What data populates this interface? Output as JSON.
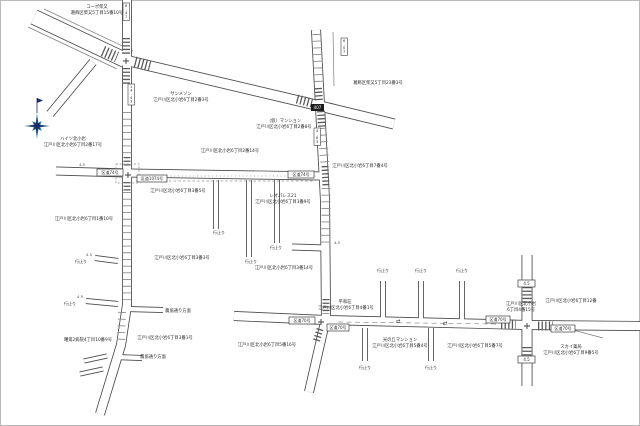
{
  "map": {
    "theme": {
      "bg": "#ffffff",
      "frame": "#b9b9b9",
      "casing": "#4a4a4a",
      "zebra": "#5a5a5a",
      "tick": "#8c8c8c",
      "dash": "#909090",
      "text": "#2b2b2b",
      "sign_border": "#3c3c3c",
      "black_sign_bg": "#1c1c1c",
      "black_sign_text": "#ffffff",
      "compass_navy": "#1b2a6d",
      "compass_teal": "#2f7d93"
    },
    "region_labels": [
      {
        "x": 97,
        "y": 8,
        "t": "コーポ柴又"
      },
      {
        "x": 97,
        "y": 14,
        "t": "葛飾区柴又5丁目15番10号"
      },
      {
        "x": 378,
        "y": 84,
        "t": "葛飾区柴又5丁目23番3号"
      },
      {
        "x": 181,
        "y": 95,
        "t": "サンメゾン"
      },
      {
        "x": 181,
        "y": 101,
        "t": "江戸川区北小岩6丁目2番3号"
      },
      {
        "x": 284,
        "y": 122,
        "t": "（仮）マンション"
      },
      {
        "x": 284,
        "y": 128,
        "t": "江戸川区北小岩6丁目2番8号"
      },
      {
        "x": 73,
        "y": 140,
        "t": "ハイツ北小岩"
      },
      {
        "x": 73,
        "y": 146,
        "t": "江戸川区北小岩6丁目2番17号"
      },
      {
        "x": 230,
        "y": 152,
        "t": "江戸川区北小岩6丁目2番14号"
      },
      {
        "x": 178,
        "y": 192,
        "t": "江戸川区北小岩6丁目3番5号"
      },
      {
        "x": 283,
        "y": 197,
        "t": "レオパレス21"
      },
      {
        "x": 283,
        "y": 203,
        "t": "江戸川区北小岩6丁目3番9号"
      },
      {
        "x": 84,
        "y": 220,
        "t": "江戸川区北小岩6丁目1番10号"
      },
      {
        "x": 182,
        "y": 259,
        "t": "江戸川区北小岩6丁目3番3号"
      },
      {
        "x": 284,
        "y": 269,
        "t": "江戸川区北小岩6丁目3番14号"
      },
      {
        "x": 360,
        "y": 167,
        "t": "江戸川区北小岩6丁目7番4号"
      },
      {
        "x": 165,
        "y": 339,
        "t": "江戸川区北小岩6丁目3番1号"
      },
      {
        "x": 88,
        "y": 341,
        "t": "曙第2病院4丁目10番9号"
      },
      {
        "x": 178,
        "y": 312,
        "t": "農協通り方面"
      },
      {
        "x": 153,
        "y": 358,
        "t": "農協通り方面"
      },
      {
        "x": 345,
        "y": 303,
        "t": "平和荘"
      },
      {
        "x": 346,
        "y": 309,
        "t": "江戸川区北小岩6丁目4番1号"
      },
      {
        "x": 521,
        "y": 305,
        "t": "江戸川区北小岩"
      },
      {
        "x": 521,
        "y": 311,
        "t": "6丁目4番15号"
      },
      {
        "x": 400,
        "y": 341,
        "t": "光の丘マンション"
      },
      {
        "x": 400,
        "y": 347,
        "t": "江戸川区北小岩6丁目5番4号"
      },
      {
        "x": 475,
        "y": 347,
        "t": "江戸川区北小岩6丁目5番7号"
      },
      {
        "x": 267,
        "y": 346,
        "t": "江戸川区北小岩6丁目5番16号"
      },
      {
        "x": 571,
        "y": 302,
        "t": "江戸川区北小岩6丁目12番"
      },
      {
        "x": 571,
        "y": 348,
        "t": "スカイ薬局"
      },
      {
        "x": 571,
        "y": 354,
        "t": "江戸川区北小岩6丁目9番5号"
      }
    ],
    "dead_end_text": "行止り",
    "dead_end_labels": [
      [
        81,
        263
      ],
      [
        70,
        305
      ],
      [
        219,
        234
      ],
      [
        251,
        263
      ],
      [
        276,
        249
      ],
      [
        383,
        272
      ],
      [
        421,
        272
      ],
      [
        462,
        272
      ],
      [
        365,
        369
      ],
      [
        431,
        369
      ]
    ],
    "road_sign_boxes": [
      {
        "x": 97,
        "y": 169,
        "w": 26,
        "t": "区道74号"
      },
      {
        "x": 137,
        "y": 175,
        "w": 30,
        "t": "区道1074号"
      },
      {
        "x": 288,
        "y": 171,
        "w": 26,
        "t": "区道74号"
      },
      {
        "x": 289,
        "y": 317,
        "w": 26,
        "t": "区道70号"
      },
      {
        "x": 327,
        "y": 324,
        "w": 22,
        "t": "区道70号"
      },
      {
        "x": 486,
        "y": 316,
        "w": 24,
        "t": "区道70号"
      },
      {
        "x": 551,
        "y": 325,
        "w": 24,
        "t": "区道70号"
      },
      {
        "x": 518,
        "y": 280,
        "w": 17,
        "t": "4.5"
      },
      {
        "x": 518,
        "y": 356,
        "w": 17,
        "t": "4.5"
      }
    ],
    "black_sign": {
      "x": 311,
      "y": 104,
      "w": 13,
      "h": 7,
      "t": "407"
    },
    "measure_boxes_vertical": [
      {
        "x": 123,
        "y": 3,
        "t": "6.47"
      },
      {
        "x": 128,
        "y": 84,
        "t": "14.43"
      },
      {
        "x": 341,
        "y": 38,
        "t": "6.07"
      },
      {
        "x": 314,
        "y": 128,
        "t": "4.63"
      }
    ],
    "measure_labels": [
      {
        "x": 89,
        "y": 256,
        "t": "4.5"
      },
      {
        "x": 80,
        "y": 298,
        "t": "4.5"
      },
      {
        "x": 337,
        "y": 244,
        "t": "4.5"
      },
      {
        "x": 82,
        "y": 166,
        "t": "4.5"
      }
    ],
    "arrow_symbols": [
      {
        "x": 398,
        "y": 323,
        "g": "⇄"
      },
      {
        "x": 445,
        "y": 325,
        "g": "⇄"
      }
    ],
    "plus_marks": [
      [
        126,
        61
      ],
      [
        128,
        175
      ],
      [
        321,
        322
      ],
      [
        527,
        326
      ]
    ],
    "geometry": {
      "roads": [
        {
          "n": "main-diagonal-road-west",
          "p": [
            [
              34,
              17
            ],
            [
              125,
              60
            ]
          ],
          "w": 16
        },
        {
          "n": "main-diagonal-road-east",
          "p": [
            [
              125,
              60
            ],
            [
              320,
              106
            ],
            [
              394,
              124
            ]
          ],
          "w": 11
        },
        {
          "n": "branch-road-southwest",
          "p": [
            [
              93,
              62
            ],
            [
              50,
              114
            ]
          ],
          "w": 9
        },
        {
          "n": "west-vertical-road",
          "p": [
            [
              127,
              -2
            ],
            [
              127,
              305
            ],
            [
              121,
              345
            ],
            [
              100,
              414
            ]
          ],
          "w": 10
        },
        {
          "n": "center-vertical-road",
          "p": [
            [
              316,
              30
            ],
            [
              320,
              106
            ],
            [
              325,
              200
            ],
            [
              326,
              318
            ],
            [
              309,
              392
            ]
          ],
          "w": 10
        },
        {
          "n": "middle-horizontal-road",
          "p": [
            [
              56,
              171
            ],
            [
              127,
              173
            ],
            [
              322,
              176
            ]
          ],
          "w": 9
        },
        {
          "n": "bottom-horizontal-road",
          "p": [
            [
              234,
              316
            ],
            [
              325,
              320
            ],
            [
              527,
              325
            ],
            [
              641,
              326
            ]
          ],
          "w": 10
        },
        {
          "n": "east-vertical-road",
          "p": [
            [
              527,
              255
            ],
            [
              527,
              386
            ]
          ],
          "w": 11
        },
        {
          "n": "side-road",
          "p": [
            [
              292,
              247
            ],
            [
              325,
              248
            ]
          ],
          "w": 7
        },
        {
          "n": "side-road",
          "p": [
            [
              126,
              309
            ],
            [
              163,
              310
            ]
          ],
          "w": 6
        },
        {
          "n": "side-road",
          "p": [
            [
              115,
              357
            ],
            [
              142,
              358
            ]
          ],
          "w": 6
        },
        {
          "n": "dead-end-stub",
          "p": [
            [
              95,
              258
            ],
            [
              118,
              261
            ]
          ],
          "w": 6
        },
        {
          "n": "dead-end-stub",
          "p": [
            [
              86,
              301
            ],
            [
              118,
              304
            ]
          ],
          "w": 6
        },
        {
          "n": "dead-end-stub",
          "p": [
            [
              216,
              180
            ],
            [
              216,
              229
            ]
          ],
          "w": 6
        },
        {
          "n": "dead-end-stub",
          "p": [
            [
              249,
              180
            ],
            [
              249,
              257
            ]
          ],
          "w": 6
        },
        {
          "n": "dead-end-stub",
          "p": [
            [
              277,
              180
            ],
            [
              277,
              243
            ]
          ],
          "w": 6
        },
        {
          "n": "dead-end-stub",
          "p": [
            [
              383,
              281
            ],
            [
              383,
              320
            ]
          ],
          "w": 6
        },
        {
          "n": "dead-end-stub",
          "p": [
            [
              421,
              281
            ],
            [
              421,
              320
            ]
          ],
          "w": 6
        },
        {
          "n": "dead-end-stub",
          "p": [
            [
              462,
              281
            ],
            [
              462,
              320
            ]
          ],
          "w": 6
        },
        {
          "n": "dead-end-stub",
          "p": [
            [
              365,
              328
            ],
            [
              365,
              361
            ]
          ],
          "w": 6
        },
        {
          "n": "dead-end-stub",
          "p": [
            [
              431,
              328
            ],
            [
              431,
              361
            ]
          ],
          "w": 6
        },
        {
          "n": "dead-end-stub",
          "p": [
            [
              84,
              361
            ],
            [
              107,
              356
            ]
          ],
          "w": 5
        },
        {
          "n": "dead-end-stub",
          "p": [
            [
              80,
              374
            ],
            [
              103,
              369
            ]
          ],
          "w": 5
        }
      ],
      "zebras": [
        {
          "p": [
            [
              126,
              38
            ],
            [
              126,
              54
            ]
          ],
          "w": 8
        },
        {
          "p": [
            [
              126,
              68
            ],
            [
              126,
              85
            ]
          ],
          "w": 8
        },
        {
          "p": [
            [
              103,
              51
            ],
            [
              117,
              57
            ]
          ],
          "w": 11
        },
        {
          "p": [
            [
              135,
              62
            ],
            [
              150,
              66
            ]
          ],
          "w": 11
        },
        {
          "p": [
            [
              318,
              88
            ],
            [
              319,
              101
            ]
          ],
          "w": 8
        },
        {
          "p": [
            [
              297,
              99
            ],
            [
              312,
              103
            ]
          ],
          "w": 9
        },
        {
          "p": [
            [
              321,
              111
            ],
            [
              322,
              127
            ]
          ],
          "w": 8
        },
        {
          "p": [
            [
              325,
              166
            ],
            [
              326,
              186
            ]
          ],
          "w": 7
        },
        {
          "p": [
            [
              127,
              157
            ],
            [
              127,
              166
            ]
          ],
          "w": 7
        },
        {
          "p": [
            [
              127,
              182
            ],
            [
              127,
              191
            ]
          ],
          "w": 7
        },
        {
          "p": [
            [
              326,
              299
            ],
            [
              326,
              314
            ]
          ],
          "w": 7
        },
        {
          "p": [
            [
              320,
              329
            ],
            [
              316,
              342
            ]
          ],
          "w": 7
        },
        {
          "p": [
            [
              527,
              287
            ],
            [
              527,
              304
            ]
          ],
          "w": 9
        },
        {
          "p": [
            [
              527,
              347
            ],
            [
              527,
              364
            ]
          ],
          "w": 9
        },
        {
          "p": [
            [
              501,
              324
            ],
            [
              516,
              324
            ]
          ],
          "w": 9
        },
        {
          "p": [
            [
              538,
              326
            ],
            [
              553,
              326
            ]
          ],
          "w": 9
        }
      ],
      "ticks": [
        {
          "p": [
            [
              127,
              112
            ],
            [
              127,
              155
            ]
          ],
          "w": 9
        },
        {
          "p": [
            [
              127,
              192
            ],
            [
              127,
              300
            ]
          ],
          "w": 9
        },
        {
          "p": [
            [
              322,
              128
            ],
            [
              325,
              165
            ]
          ],
          "w": 9
        },
        {
          "p": [
            [
              326,
              188
            ],
            [
              326,
              244
            ]
          ],
          "w": 9
        },
        {
          "p": [
            [
              317,
              34
            ],
            [
              319,
              86
            ]
          ],
          "w": 9
        },
        {
          "p": [
            [
              122,
              312
            ],
            [
              121,
              342
            ]
          ],
          "w": 8
        }
      ],
      "dashes": [
        {
          "p": [
            [
              136,
              181
            ],
            [
              314,
              181
            ]
          ],
          "da": "2.5 2.2"
        },
        {
          "p": [
            [
              140,
              176
            ],
            [
              316,
              176
            ]
          ],
          "da": "1 2.8"
        },
        {
          "p": [
            [
              338,
              322
            ],
            [
              498,
              324
            ]
          ],
          "da": "5 3.5"
        }
      ],
      "junction_box": {
        "x": 116,
        "y": 164,
        "w": 23,
        "h": 19
      },
      "extras": [
        [
          [
            44,
            9
          ],
          [
            133,
            51
          ]
        ],
        [
          [
            28,
            27
          ],
          [
            117,
            69
          ]
        ],
        [
          [
            333,
            32
          ],
          [
            334,
            86
          ]
        ],
        [
          [
            573,
            330
          ],
          [
            603,
            338
          ]
        ],
        [
          [
            330,
            103
          ],
          [
            392,
            121
          ]
        ]
      ]
    },
    "compass": {
      "cx": 37,
      "cy": 126,
      "r_long": 13,
      "r_short": 7,
      "r_inner": 3.5,
      "stem_top": 98,
      "stem_bottom": 113
    }
  }
}
